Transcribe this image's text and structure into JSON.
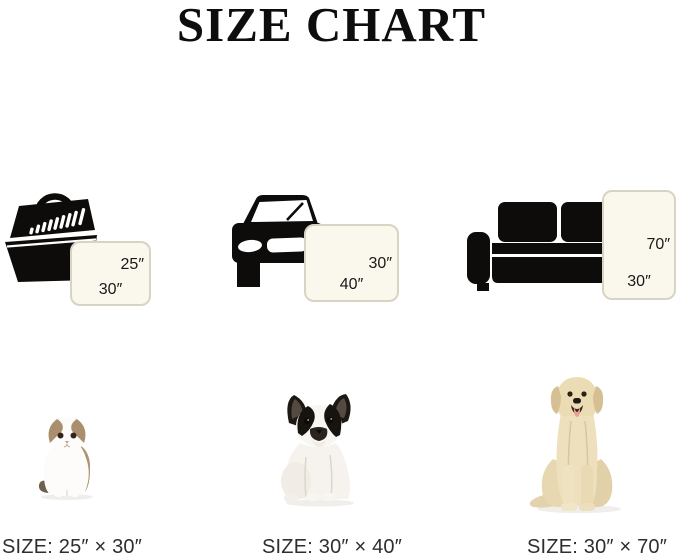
{
  "title": "SIZE CHART",
  "columns": [
    {
      "scene_icon": "pet-carrier-icon",
      "animal_icon": "cat-photo",
      "pad": {
        "side_label": "25″",
        "bottom_label": "30″"
      },
      "caption": "SIZE: 25″ × 30″"
    },
    {
      "scene_icon": "car-icon",
      "animal_icon": "french-bulldog-photo",
      "pad": {
        "side_label": "30″",
        "bottom_label": "40″"
      },
      "caption": "SIZE: 30″ × 40″"
    },
    {
      "scene_icon": "sofa-icon",
      "animal_icon": "labrador-photo",
      "pad": {
        "side_label": "70″",
        "bottom_label": "30″"
      },
      "caption": "SIZE: 30″ × 70″"
    }
  ],
  "colors": {
    "icon_black": "#0d0c0a",
    "pad_fill": "#faf7ed",
    "pad_border": "#d8d4c4",
    "caption_text": "#2e2e2e"
  }
}
